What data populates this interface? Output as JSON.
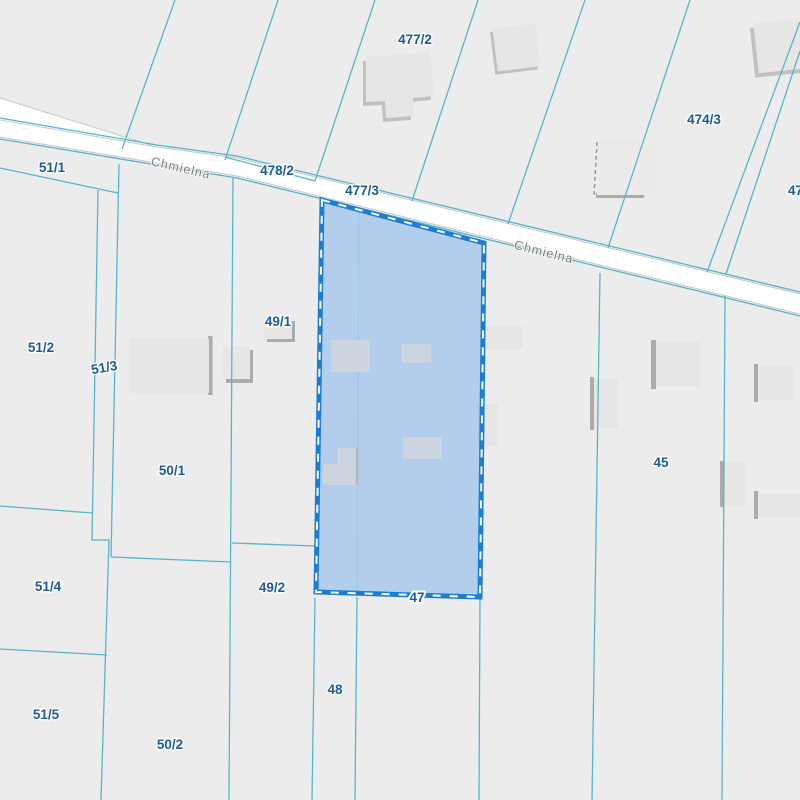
{
  "map": {
    "kind": "cadastral-parcel-map",
    "street": {
      "name": "Chmielna"
    },
    "selected_parcel": {
      "number": "47"
    },
    "labels": {
      "p51_1": "51/1",
      "p51_2": "51/2",
      "p51_3": "51/3",
      "p51_4": "51/4",
      "p51_5": "51/5",
      "p50_1": "50/1",
      "p50_2": "50/2",
      "p49_1": "49/1",
      "p49_2": "49/2",
      "p48": "48",
      "p45": "45",
      "p478_2": "478/2",
      "p477_2": "477/2",
      "p477_3": "477/3",
      "p474_3": "474/3",
      "p47_edge": "47",
      "p47_selected": "47"
    }
  },
  "colors": {
    "background": "#ECECEC",
    "parcel_line": "#58B4CC",
    "selected_parcel_fill": "#A9C9EC",
    "selected_parcel_border": "#1B7ED3",
    "selected_dash": "#FFFFFF",
    "parcel_label_text": "#1E5C96",
    "street_label_text": "#7D7D7D",
    "road_fill": "#FFFFFF",
    "road_edge": "#C9C9C9",
    "building_fill": "#E7E6E4",
    "building_fill_selected": "#CBD4DF",
    "building_shadow": "#ABABAB"
  }
}
